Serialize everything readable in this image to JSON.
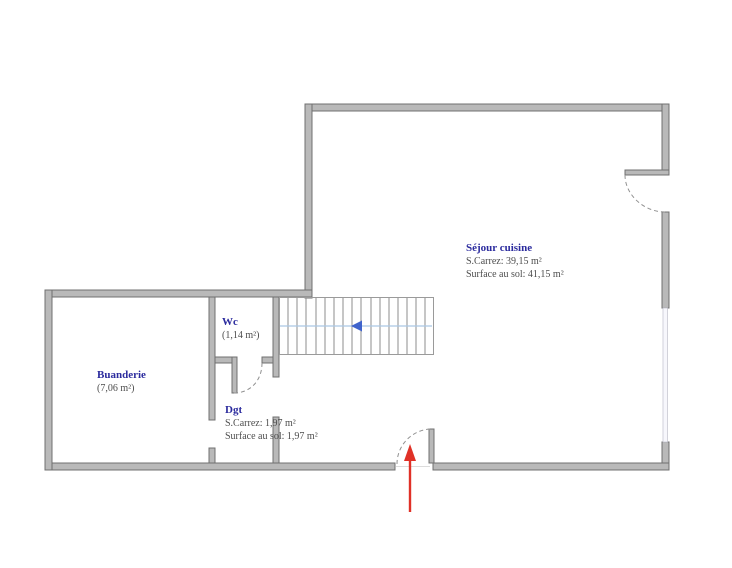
{
  "rooms": {
    "sejour": {
      "name": "Séjour cuisine",
      "carrez": "S.Carrez: 39,15 m²",
      "floor_area": "Surface au sol: 41,15 m²"
    },
    "wc": {
      "name": "Wc",
      "area": "(1,14 m²)"
    },
    "buanderie": {
      "name": "Buanderie",
      "area": "(7,06 m²)"
    },
    "dgt": {
      "name": "Dgt",
      "carrez": "S.Carrez: 1,97 m²",
      "floor_area": "Surface au sol: 1,97 m²"
    }
  },
  "icons": {
    "stair_direction": "stair-direction-left-arrow",
    "entrance": "entrance-up-arrow"
  },
  "colors": {
    "wall_fill": "#b9b9b9",
    "wall_edge": "#707070",
    "room_label": "#2b2b9e",
    "detail_text": "#4d4d4d",
    "stair_guide": "#aac7e4",
    "stair_arrow": "#3f63cc",
    "entrance_arrow": "#e03127",
    "door_arc": "#909090",
    "window_glass": "#f7f7fc"
  }
}
